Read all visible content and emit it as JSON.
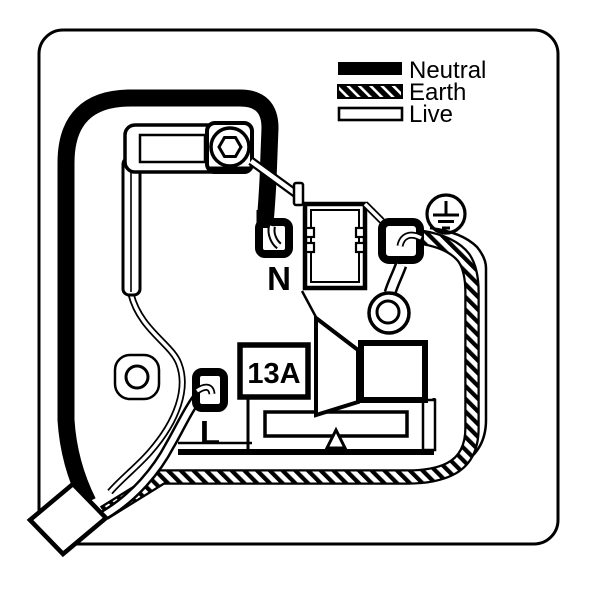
{
  "diagram": {
    "title": "13A plug internal wiring diagram",
    "background_color": "#ffffff",
    "line_color": "#000000"
  },
  "legend": {
    "items": [
      {
        "id": "neutral",
        "label": "Neutral",
        "swatch": "solid-black"
      },
      {
        "id": "earth",
        "label": "Earth",
        "swatch": "hatched"
      },
      {
        "id": "live",
        "label": "Live",
        "swatch": "white-outline"
      }
    ]
  },
  "labels": {
    "neutral_terminal": "N",
    "live_terminal": "L",
    "fuse_rating": "13A"
  },
  "icons": {
    "earth_symbol": "earth-ground-icon",
    "screws": "screw-head-icon"
  }
}
